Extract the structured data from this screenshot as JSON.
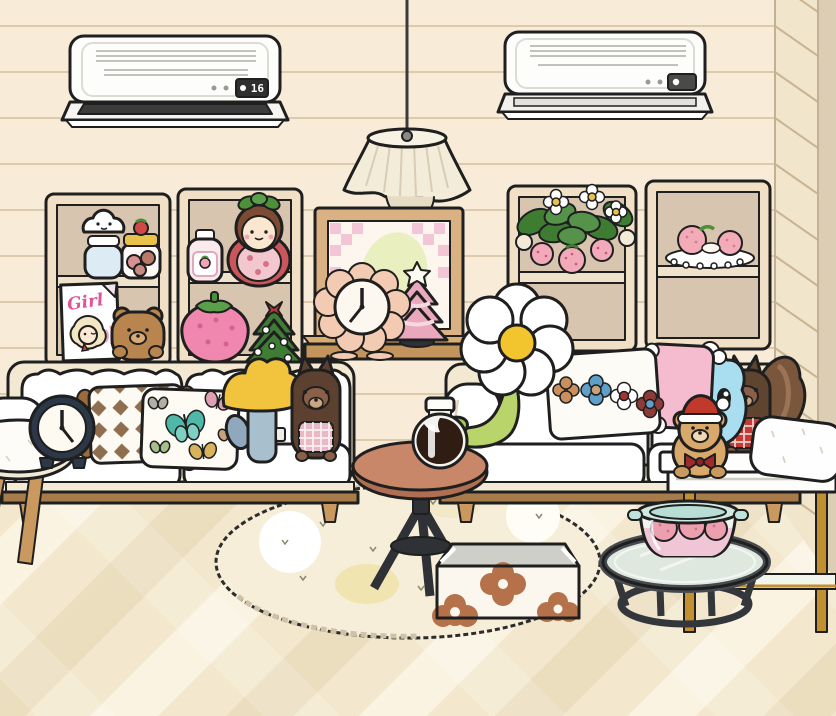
{
  "ac_left": {
    "label": "wall air conditioner (left)",
    "display": "16"
  },
  "ac_right": {
    "label": "wall air conditioner (right)",
    "display": ""
  },
  "magazine": {
    "title": "Girl"
  },
  "clocks": {
    "alarm_clock_time": "12:25",
    "flower_clock_time": "12:35"
  },
  "palette": {
    "wall": "#f8ecd8",
    "wall_line": "#d8c5a6",
    "wall_corner_strip": "#dbceb4",
    "floor_light": "#faf3e2",
    "floor_mid": "#f3e8cd",
    "floor_dark": "#ebdebf",
    "outline": "#1f1f1f",
    "sofa_cream": "#f3e8d2",
    "cushion_white": "#ffffff",
    "wood": "#c9995f",
    "wood_dark": "#a87c4a",
    "shelf_frame": "#f2e0c6",
    "shelf_back": "#d8c5b0",
    "table_wood": "#c9876a",
    "metal_dark": "#2e3136",
    "pink": "#f5bcd0",
    "strawberry_pink": "#ef87ae",
    "leaf_green": "#4e8f3a",
    "stem_green": "#b8d46a",
    "mushroom_yellow": "#f2c33c",
    "mushroom_stem": "#a8bfce",
    "monster_blue": "#a9def0",
    "squirrel_brown": "#5c4030",
    "teddy_tan": "#d9a96c",
    "santa_red": "#c0392b",
    "gold": "#c29030",
    "daisy_center": "#f2c52e"
  },
  "objects": [
    {
      "id": "ac-left",
      "label": "air conditioner set to 16"
    },
    {
      "id": "ac-right",
      "label": "air conditioner"
    },
    {
      "id": "pendant-lamp",
      "label": "fabric pendant lamp"
    },
    {
      "id": "shelf-unit",
      "label": "cream display shelf"
    },
    {
      "id": "cloud-jar",
      "label": "cloud face jar"
    },
    {
      "id": "strawberry-cookie-jar",
      "label": "strawberry cookie jar"
    },
    {
      "id": "girl-magazine",
      "label": "Girl magazine"
    },
    {
      "id": "teddy-bear",
      "label": "brown teddy bear"
    },
    {
      "id": "lotion-bottle",
      "label": "strawberry lotion bottle"
    },
    {
      "id": "strawberry-doll",
      "label": "strawberry girl doll"
    },
    {
      "id": "strawberry-plush",
      "label": "pink strawberry plush"
    },
    {
      "id": "christmas-tree",
      "label": "green christmas tree"
    },
    {
      "id": "strawberry-plant",
      "label": "potted strawberry plant"
    },
    {
      "id": "dessert-plate",
      "label": "strawberry dessert plate"
    },
    {
      "id": "picture-frame",
      "label": "framed picture"
    },
    {
      "id": "window-sill",
      "label": "wooden sill shelf"
    },
    {
      "id": "flower-clock",
      "label": "flower table clock"
    },
    {
      "id": "pink-tree",
      "label": "pink mini christmas tree"
    },
    {
      "id": "sofa",
      "label": "cream sofa"
    },
    {
      "id": "stool",
      "label": "white stool"
    },
    {
      "id": "alarm-clock",
      "label": "navy alarm clock"
    },
    {
      "id": "argyle-pillow",
      "label": "argyle tassel pillow"
    },
    {
      "id": "butterfly-pillow",
      "label": "butterfly print pillow"
    },
    {
      "id": "mushroom-plush",
      "label": "yellow mushroom plush"
    },
    {
      "id": "squirrel-plush",
      "label": "small squirrel plush"
    },
    {
      "id": "flower-plush",
      "label": "white daisy plush"
    },
    {
      "id": "floral-pillow",
      "label": "floral print pillow"
    },
    {
      "id": "pink-pompom-pillow",
      "label": "pink pompom pillow"
    },
    {
      "id": "monster-plush",
      "label": "blue monster plush"
    },
    {
      "id": "squirrel-tail-plush",
      "label": "squirrel plush with bushy tail"
    },
    {
      "id": "white-pillow",
      "label": "white pillow"
    },
    {
      "id": "santa-teddy",
      "label": "teddy bear with santa hat"
    },
    {
      "id": "side-table",
      "label": "round tripod side table"
    },
    {
      "id": "syrup-jar",
      "label": "jar of syrup"
    },
    {
      "id": "rug",
      "label": "oval cream rug"
    },
    {
      "id": "storage-box",
      "label": "open flower box"
    },
    {
      "id": "console-table",
      "label": "white and gold console table"
    },
    {
      "id": "coffee-table",
      "label": "round glass coffee table"
    },
    {
      "id": "strawberry-pot",
      "label": "glass pot with strawberries"
    }
  ]
}
